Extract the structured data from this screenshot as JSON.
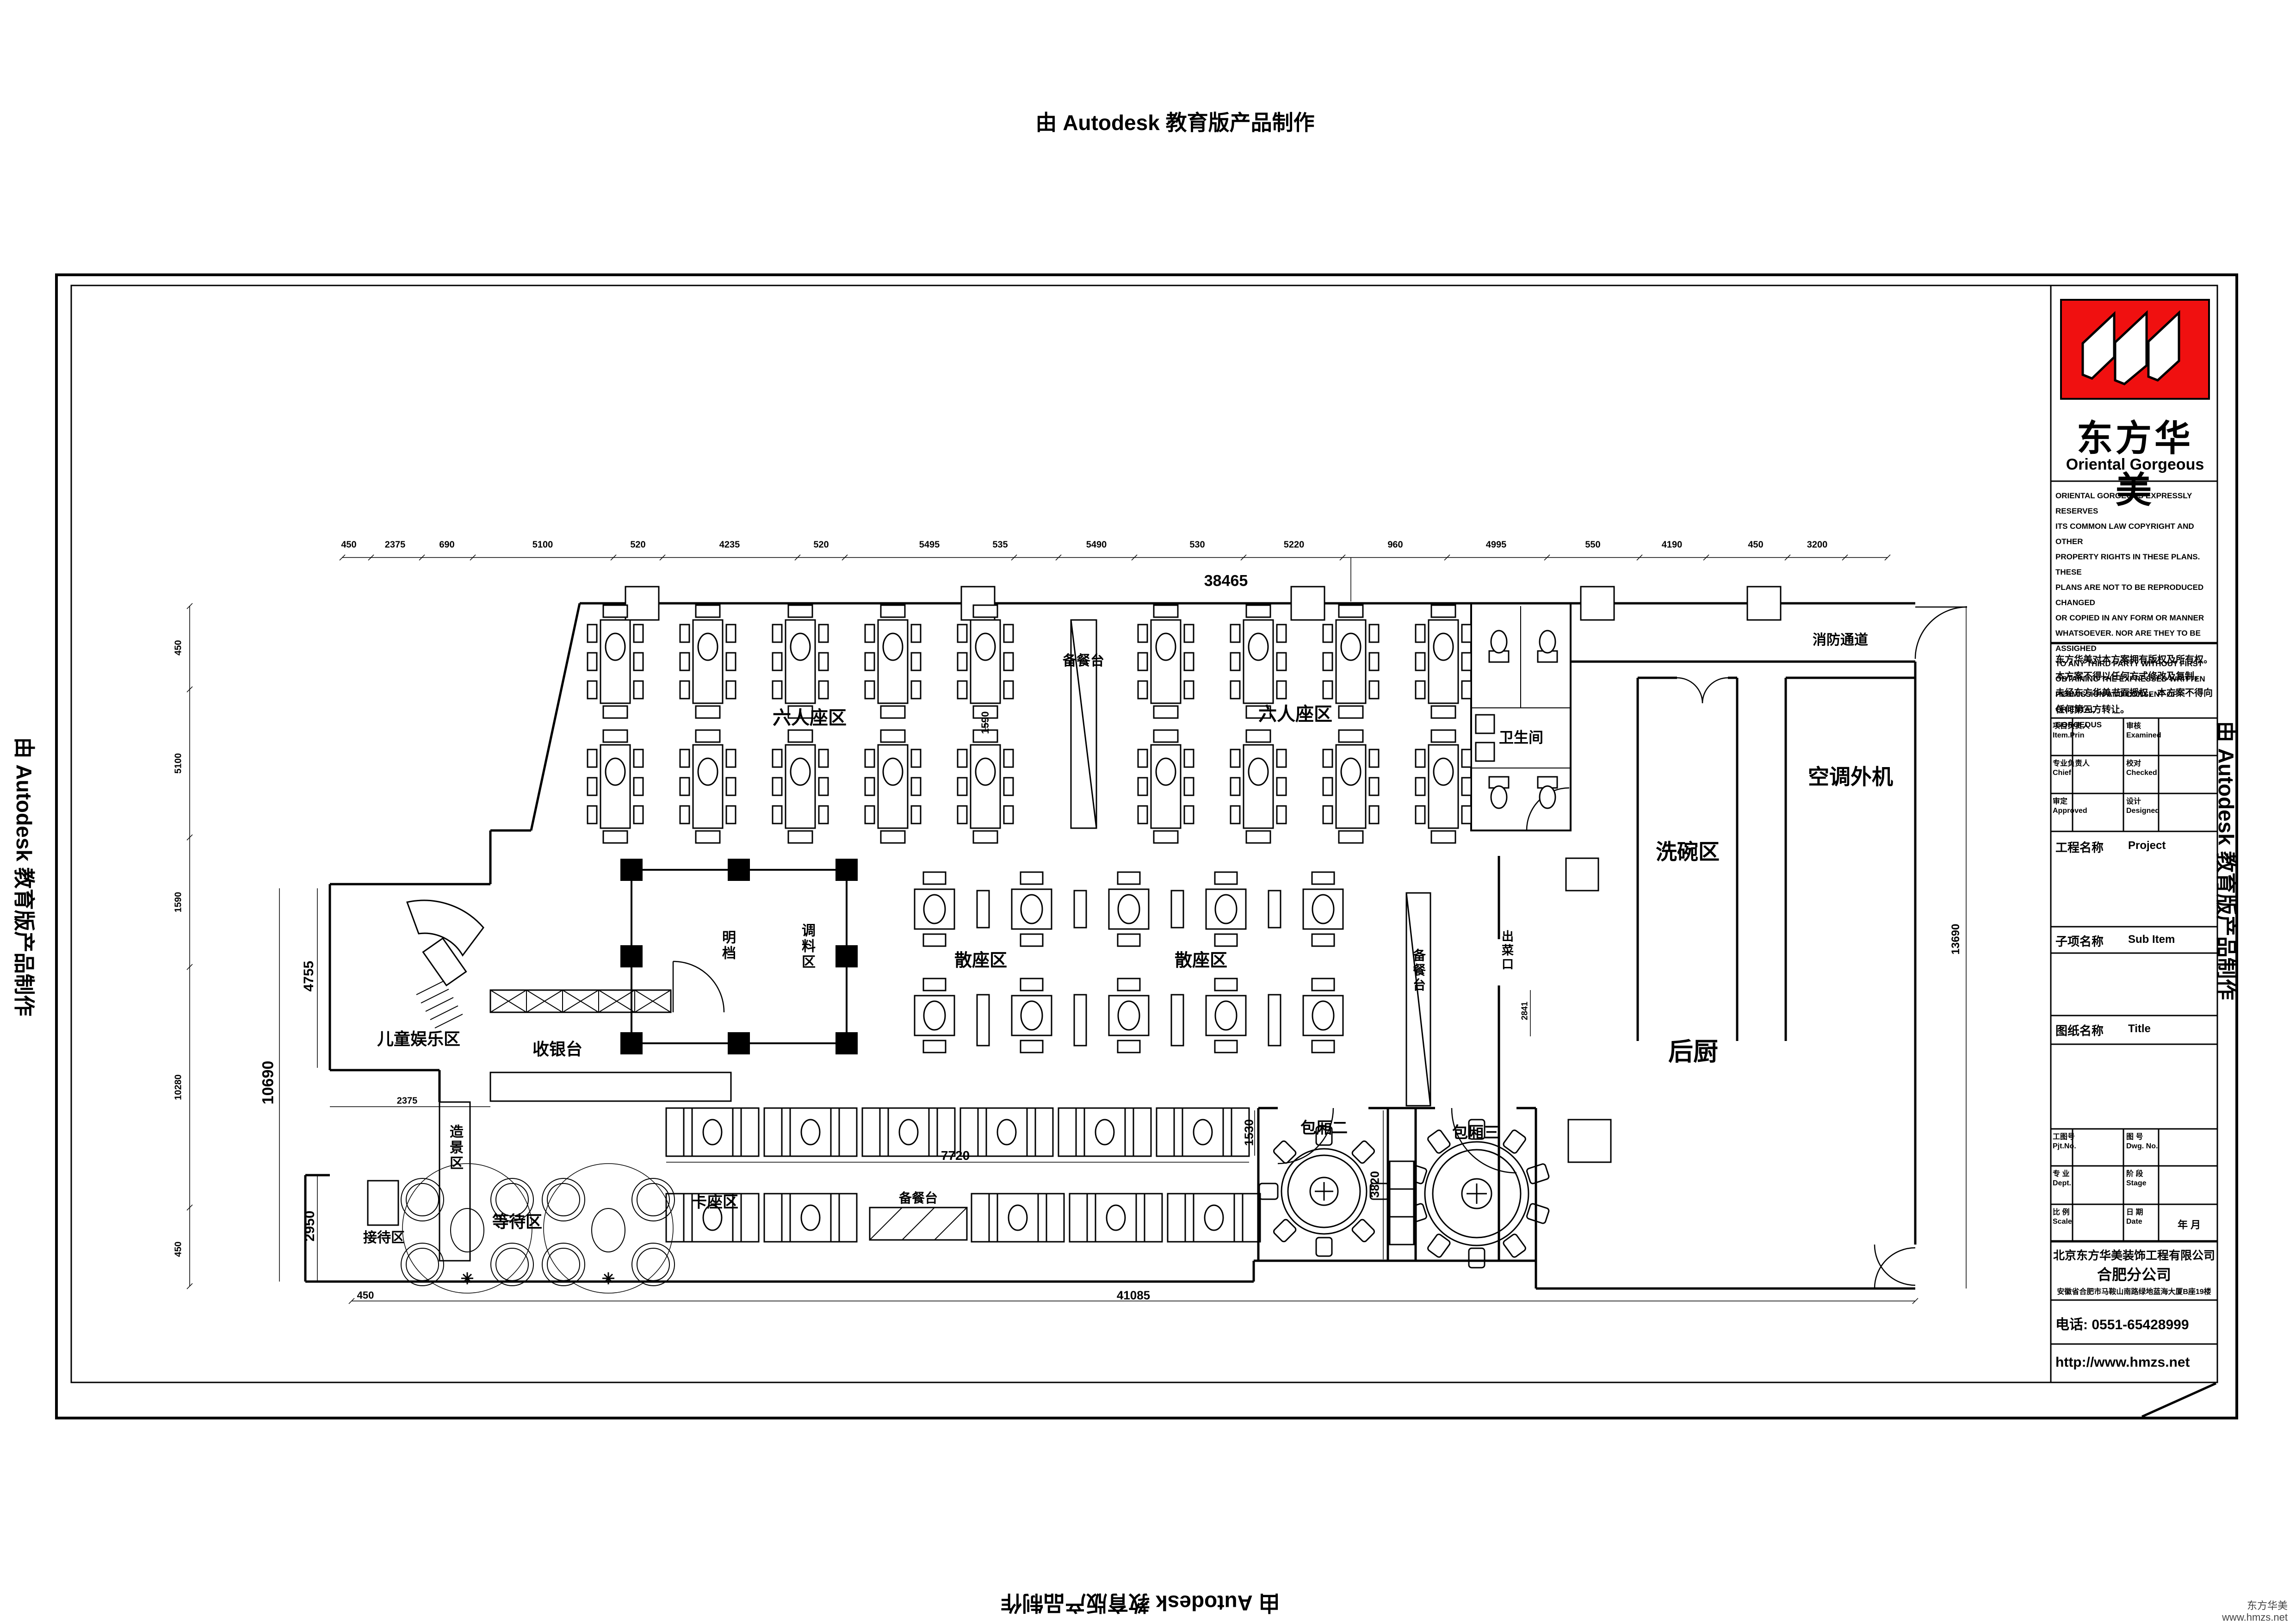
{
  "stamps": {
    "top": "由 Autodesk 教育版产品制作",
    "bottom": "由 Autodesk 教育版产品制作",
    "left": "由 Autodesk 教育版产品制作",
    "right": "由 Autodesk 教育版产品制作"
  },
  "watermark": {
    "line1": "东方华美",
    "line2": "www.hmzs.net"
  },
  "title_block": {
    "logo": {
      "cn": "东方华美",
      "en": "Oriental  Gorgeous"
    },
    "copyright": "ORIENTAL GORGEOUS EXPRESSLY RESERVES\nITS COMMON LAW COPYRIGHT AND OTHER\nPROPERTY RIGHTS IN THESE PLANS. THESE\nPLANS ARE NOT TO BE REPRODUCED CHANGED\nOR COPIED IN ANY FORM OR MANNER\nWHATSOEVER. NOR ARE THEY TO BE ASSIGHED\nTO ANY THIRD PARTY WITHOUT FIRST\nOBTAINING THE EXPRESSED WRITTEN\nPERMISSION AND CONSENT OF ORIENTAL\nGORGEOUS",
    "disclaimer": "东方华美对本方案拥有版权及所有权。\n本方案不得以任何方式修改及复制。\n未经东方华美书面授权，本方案不得向\n任何第三方转让。",
    "fields": {
      "r1c1": {
        "cn": "项目负责人",
        "en": "Item.Prin"
      },
      "r1c2": {
        "cn": "审核",
        "en": "Examined"
      },
      "r2c1": {
        "cn": "专业负责人",
        "en": "Chief"
      },
      "r2c2": {
        "cn": "校对",
        "en": "Checked"
      },
      "r3c1": {
        "cn": "审定",
        "en": "Approved"
      },
      "r3c2": {
        "cn": "设计",
        "en": "Designed"
      }
    },
    "sections": {
      "project": {
        "cn": "工程名称",
        "en": "Project"
      },
      "sub_item": {
        "cn": "子项名称",
        "en": "Sub Item"
      },
      "title": {
        "cn": "图纸名称",
        "en": "Title"
      }
    },
    "fields2": {
      "r1c1": {
        "cn": "工图号",
        "en": "Pjt.No."
      },
      "r1c2": {
        "cn": "图 号",
        "en": "Dwg. No."
      },
      "r2c1": {
        "cn": "专 业",
        "en": "Dept."
      },
      "r2c2": {
        "cn": "阶 段",
        "en": "Stage"
      },
      "r3c1": {
        "cn": "比 例",
        "en": "Scale"
      },
      "r3c2": {
        "cn": "日 期",
        "en": "Date"
      },
      "date_value": "年      月"
    },
    "company": {
      "name": "北京东方华美装饰工程有限公司",
      "branch": "合肥分公司",
      "address": "安徽省合肥市马鞍山南路绿地蓝海大厦B座19楼",
      "phone": "电话: 0551-65428999",
      "website": "http://www.hmzs.net"
    }
  },
  "plan": {
    "areas": {
      "six_left": "六人座区",
      "six_right": "六人座区",
      "serving_top": "备餐台",
      "serving_mid": "备餐台",
      "serving_bottom": "备餐台",
      "toilet": "卫生间",
      "fire": "消防通道",
      "dishwash": "洗碗区",
      "ac": "空调外机",
      "kitchen": "后厨",
      "out": "出菜口",
      "open1": "散座区",
      "open2": "散座区",
      "mingdang": "明档",
      "spice": "调料区",
      "kids": "儿童娱乐区",
      "cashier": "收银台",
      "scenery": "造景区",
      "reception": "接待区",
      "waiting": "等待区",
      "booth": "卡座区",
      "room2": "包厢二",
      "room3": "包厢三"
    },
    "dimensions": {
      "overall": "38465",
      "d4755": "4755",
      "d10690": "10690",
      "d2950": "2950",
      "d7720": "7720",
      "d1530": "1530",
      "d3820": "3820",
      "d1590": "1590",
      "d2375": "2375",
      "d2841": "2841",
      "d450b": "450",
      "d41085": "41085",
      "d13690": "13690"
    },
    "top_chain": [
      "450",
      "2375",
      "690",
      "5100",
      "520",
      "4235",
      "520",
      "5495",
      "535",
      "5490",
      "530",
      "5220",
      "960",
      "4995",
      "550",
      "4190",
      "450",
      "3200"
    ],
    "left_chain": [
      "450",
      "5100",
      "1590",
      "10280",
      "450"
    ]
  }
}
